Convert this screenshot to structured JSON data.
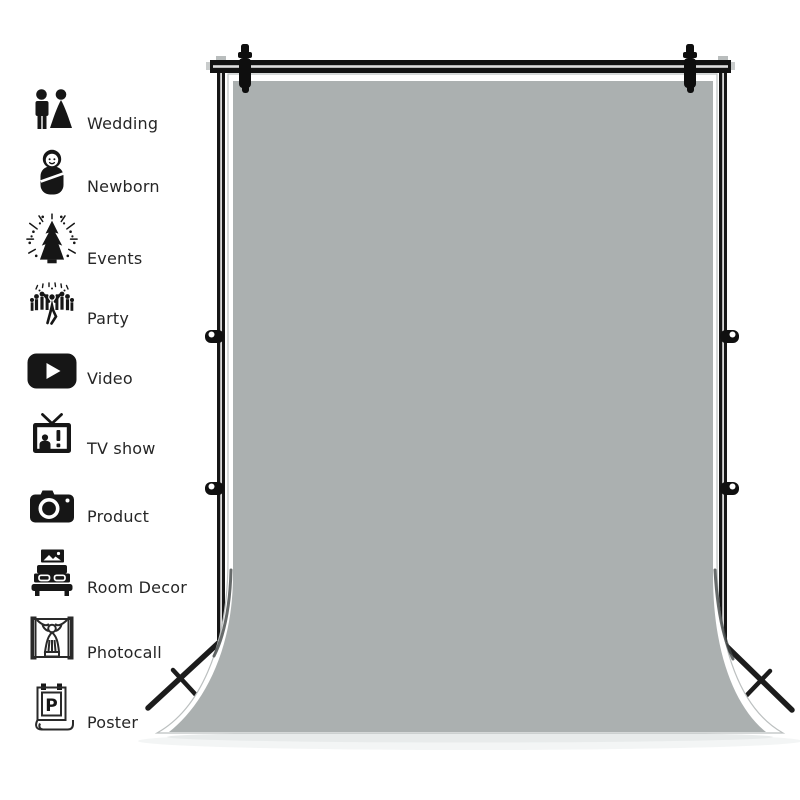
{
  "product_image": {
    "subject": "Plain grey photography backdrop sweep hanging on a black background support stand",
    "colors": {
      "backdrop_grey": "#abb0b0",
      "stand_black": "#161616",
      "page_background": "#ffffff",
      "label_text": "#262626"
    }
  },
  "sidebar": {
    "items": [
      {
        "label": "Wedding",
        "icon": "wedding-couple-icon"
      },
      {
        "label": "Newborn",
        "icon": "newborn-baby-icon"
      },
      {
        "label": "Events",
        "icon": "fireworks-tree-icon"
      },
      {
        "label": "Party",
        "icon": "party-crowd-icon"
      },
      {
        "label": "Video",
        "icon": "video-play-icon"
      },
      {
        "label": "TV show",
        "icon": "tv-screen-icon"
      },
      {
        "label": "Product",
        "icon": "camera-icon"
      },
      {
        "label": "Room Decor",
        "icon": "bedroom-icon"
      },
      {
        "label": "Photocall",
        "icon": "photocall-stage-icon"
      },
      {
        "label": "Poster",
        "icon": "poster-icon"
      }
    ]
  }
}
